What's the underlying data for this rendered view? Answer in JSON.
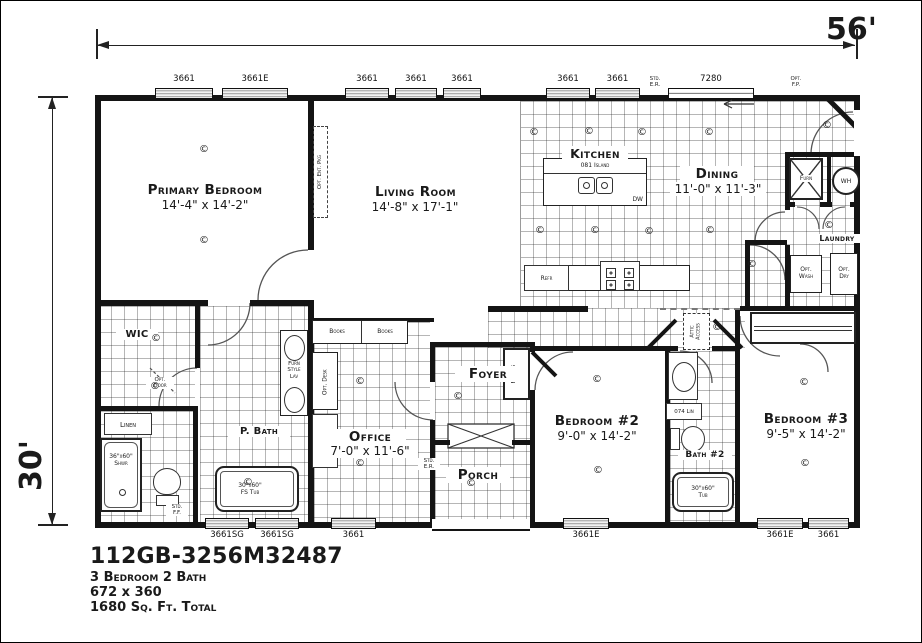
{
  "title_block": {
    "model": "112GB-3256M32487",
    "beds_baths": "3 Bedroom 2 Bath",
    "box_dims": "672 x 360",
    "sqft": "1680 Sq. Ft. Total"
  },
  "dimensions": {
    "width": "56'",
    "depth": "30'"
  },
  "rooms": {
    "primary": {
      "name": "Primary Bedroom",
      "size": "14'-4\" x 14'-2\""
    },
    "living": {
      "name": "Living Room",
      "size": "14'-8\" x 17'-1\""
    },
    "kitchen": {
      "name": "Kitchen"
    },
    "dining": {
      "name": "Dining",
      "size": "11'-0\" x 11'-3\""
    },
    "office": {
      "name": "Office",
      "size": "7'-0\" x 11'-6\""
    },
    "foyer": {
      "name": "Foyer"
    },
    "porch": {
      "name": "Porch"
    },
    "bedroom2": {
      "name": "Bedroom #2",
      "size": "9'-0\" x 14'-2\""
    },
    "bedroom3": {
      "name": "Bedroom #3",
      "size": "9'-5\" x 14'-2\""
    },
    "pbath": {
      "name": "P. Bath"
    },
    "bath2": {
      "name": "Bath #2"
    },
    "wic": {
      "name": "WIC"
    },
    "laundry": {
      "name": "Laundry"
    }
  },
  "fixtures": {
    "island": "081 Island",
    "dw": "DW",
    "refr": "Refr",
    "wh": "WH",
    "furn": "Furn",
    "opt_wash": "Opt.\nWash",
    "opt_dry": "Opt.\nDry",
    "linen": "Linen",
    "shower": "36\"x60\"\nShwr",
    "fs_tub": "30\"x60\"\nFS Tub",
    "tub2": "30\"x60\"\nTub",
    "lav": "Furn\nStyle\nLav",
    "lin074": "074 Lin",
    "books_left": "Books",
    "books_right": "Books",
    "opt_desk": "Opt. Desk",
    "attic": "Attic\nAccess",
    "opt_door": "Opt.\nDoor",
    "opt_ent": "Opt. Ent. Pkg",
    "foyer_niche": "Folding\nVanity"
  },
  "notes": {
    "std_er_top": "Std.\nE.R.",
    "opt_fp": "Opt.\nF.P.",
    "std_er_porch": "Std.\nE.R.",
    "std_ff": "Std.\nF.F."
  },
  "symbols": {
    "ceiling_light": "©"
  },
  "windows": {
    "top": [
      {
        "label": "3661",
        "x": 155,
        "w": 58
      },
      {
        "label": "3661E",
        "x": 222,
        "w": 66
      },
      {
        "label": "3661",
        "x": 345,
        "w": 44
      },
      {
        "label": "3661",
        "x": 395,
        "w": 42
      },
      {
        "label": "3661",
        "x": 443,
        "w": 38
      },
      {
        "label": "3661",
        "x": 546,
        "w": 44
      },
      {
        "label": "3661",
        "x": 595,
        "w": 45
      },
      {
        "label": "7280",
        "x": 668,
        "w": 86,
        "slider": true
      }
    ],
    "bottom": [
      {
        "label": "3661SG",
        "x": 205,
        "w": 44
      },
      {
        "label": "3661SG",
        "x": 255,
        "w": 44
      },
      {
        "label": "3661",
        "x": 331,
        "w": 45
      },
      {
        "label": "3661E",
        "x": 563,
        "w": 46
      },
      {
        "label": "3661E",
        "x": 757,
        "w": 46
      },
      {
        "label": "3661",
        "x": 808,
        "w": 41
      }
    ]
  },
  "lights": [
    [
      205,
      152
    ],
    [
      205,
      243
    ],
    [
      535,
      135
    ],
    [
      590,
      134
    ],
    [
      643,
      135
    ],
    [
      710,
      135
    ],
    [
      541,
      233
    ],
    [
      596,
      233
    ],
    [
      650,
      234
    ],
    [
      711,
      233
    ],
    [
      828,
      128
    ],
    [
      830,
      228
    ],
    [
      157,
      341
    ],
    [
      156,
      389
    ],
    [
      249,
      485
    ],
    [
      361,
      384
    ],
    [
      361,
      466
    ],
    [
      459,
      399
    ],
    [
      472,
      486
    ],
    [
      598,
      382
    ],
    [
      599,
      473
    ],
    [
      718,
      330
    ],
    [
      805,
      385
    ],
    [
      806,
      466
    ],
    [
      753,
      267
    ]
  ]
}
